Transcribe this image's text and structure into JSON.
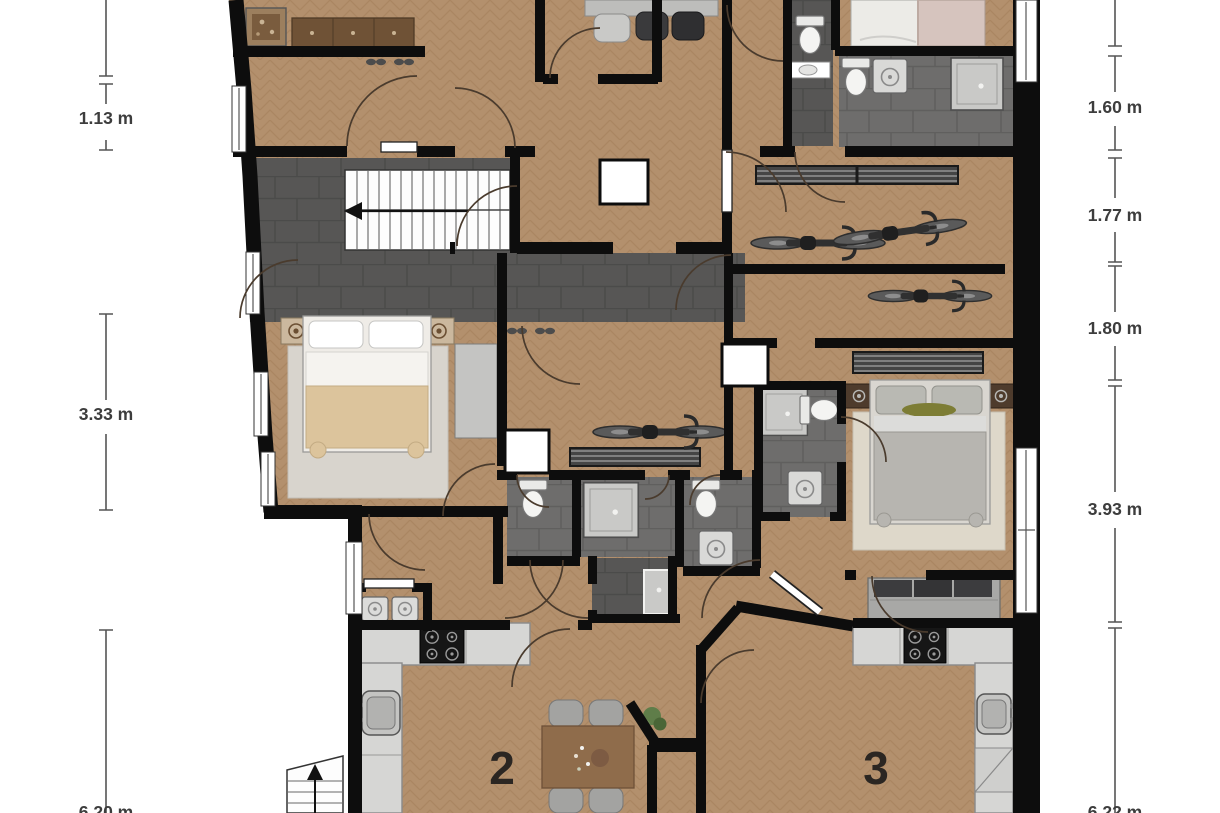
{
  "title": "apartment-floor-plan",
  "dimensions": {
    "left": [
      {
        "label": "1.13 m"
      },
      {
        "label": "3.33 m"
      },
      {
        "label": "6.20 m"
      }
    ],
    "right": [
      {
        "label": "1.60 m"
      },
      {
        "label": "1.77 m"
      },
      {
        "label": "1.80 m"
      },
      {
        "label": "3.93 m"
      },
      {
        "label": "6.22 m"
      }
    ]
  },
  "rooms": {
    "unit2_label": "2",
    "unit3_label": "3"
  },
  "colors": {
    "wood_floor": "#b3906d",
    "wood_line": "#a17d59",
    "tile_dark": "#575655",
    "tile_mid": "#6e6d6c",
    "wall": "#0d0d0d",
    "counter": "#d6d6d4",
    "stove": "#161616",
    "bed_blanket_beige": "#dcc49c",
    "bed_blanket_gray": "#b7b5b0",
    "bed_pink": "#d6c4be",
    "rug_light": "#d8d4cd",
    "sofa_gray": "#a8a8a6",
    "table_wood": "#8f6c4b",
    "door_arc": "#4a3b2d",
    "dimension_text": "#3d3d3d",
    "unit_number": "#2b2622",
    "plant_green": "#5f7d49"
  },
  "icons": [
    "double-bed-icon",
    "single-bed-icon",
    "bike-icon",
    "toilet-icon",
    "shower-icon",
    "washing-machine-icon",
    "stove-icon",
    "kitchen-sink-icon",
    "bathroom-sink-icon",
    "dining-table-icon",
    "chair-icon",
    "sofa-icon",
    "radiator-icon",
    "stairs-icon",
    "entrance-stairs-icon",
    "plant-icon",
    "wardrobe-icon",
    "nightstand-icon",
    "rug-icon",
    "sideboard-icon",
    "picture-frame-icon",
    "shoes-icon",
    "shaft-icon",
    "door-swing-icon",
    "window-icon"
  ]
}
